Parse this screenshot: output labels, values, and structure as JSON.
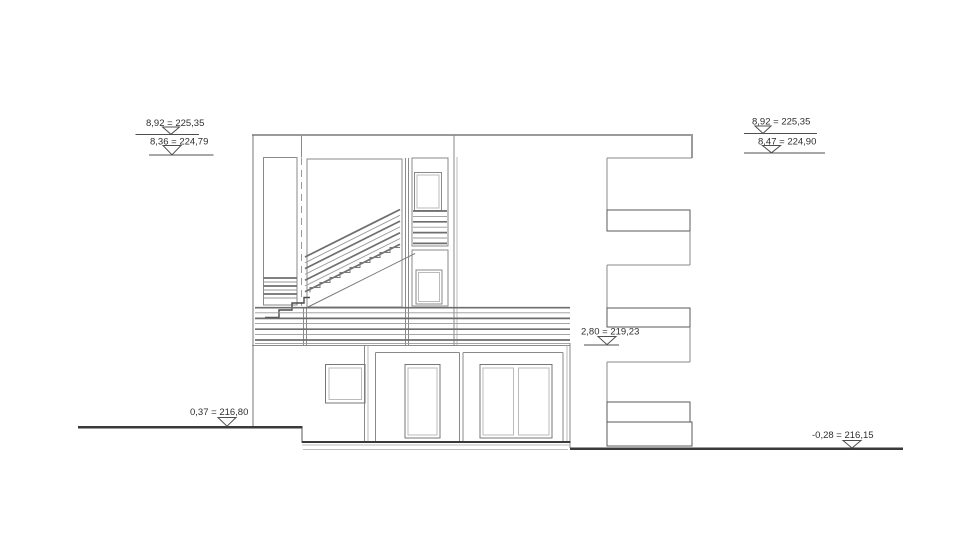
{
  "drawing": {
    "type": "architectural-elevation",
    "background_color": "#ffffff",
    "line_color": "#8a8a8a",
    "dark_line_color": "#3a3a3a"
  },
  "level_markers": {
    "top_left_upper": "8,92 = 225,35",
    "top_left_lower": "8,36 = 224,79",
    "top_right_upper": "8,92 = 225,35",
    "top_right_lower": "8,47 = 224,90",
    "terrace_right": "2,80 = 219,23",
    "ground_left": "0,37 = 216,80",
    "ground_right": "-0,28 = 216,15"
  }
}
